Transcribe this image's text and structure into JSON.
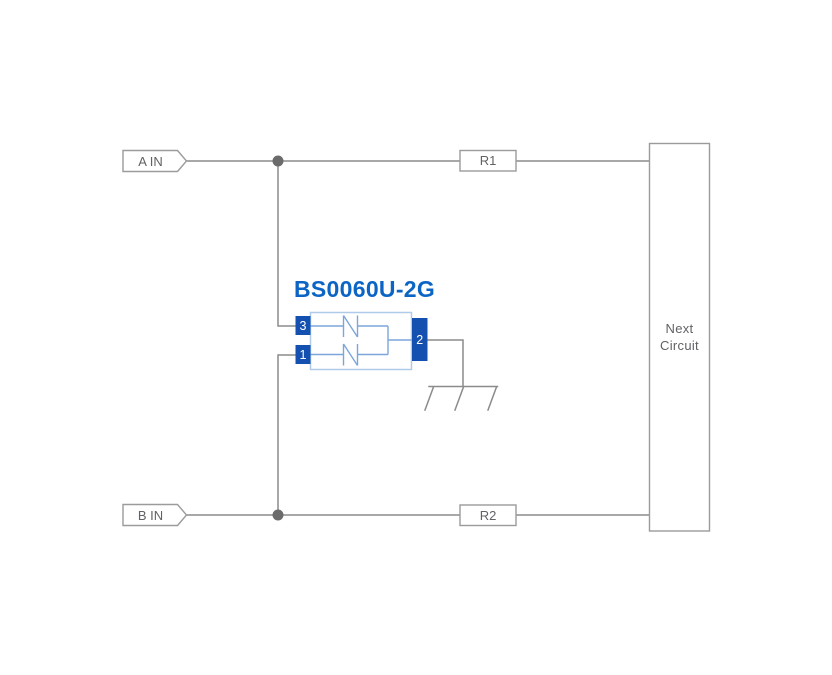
{
  "diagram": {
    "component": {
      "label": "BS0060U-2G",
      "pin_top_left": "3",
      "pin_bottom_left": "1",
      "pin_right": "2"
    },
    "ports": {
      "a": "A IN",
      "b": "B IN"
    },
    "resistors": {
      "r1": "R1",
      "r2": "R2"
    },
    "next_circuit": {
      "line1": "Next",
      "line2": "Circuit"
    },
    "icons": {
      "ground": "earth-ground-symbol",
      "junction_a": "junction-dot",
      "junction_b": "junction-dot",
      "port_a_flag": "input-port-flag",
      "port_b_flag": "input-port-flag"
    },
    "colors": {
      "background": "#ffffff",
      "wire": "#8b8b8b",
      "outline": "#9b9b9b",
      "text": "#606266",
      "junction": "#6b6b6b",
      "component_label": "#0c64c4",
      "pin_fill": "#1450b0",
      "pin_text": "#ffffff",
      "body_outline": "#b0cbe9",
      "symbol_stroke": "#7ca6da"
    }
  }
}
